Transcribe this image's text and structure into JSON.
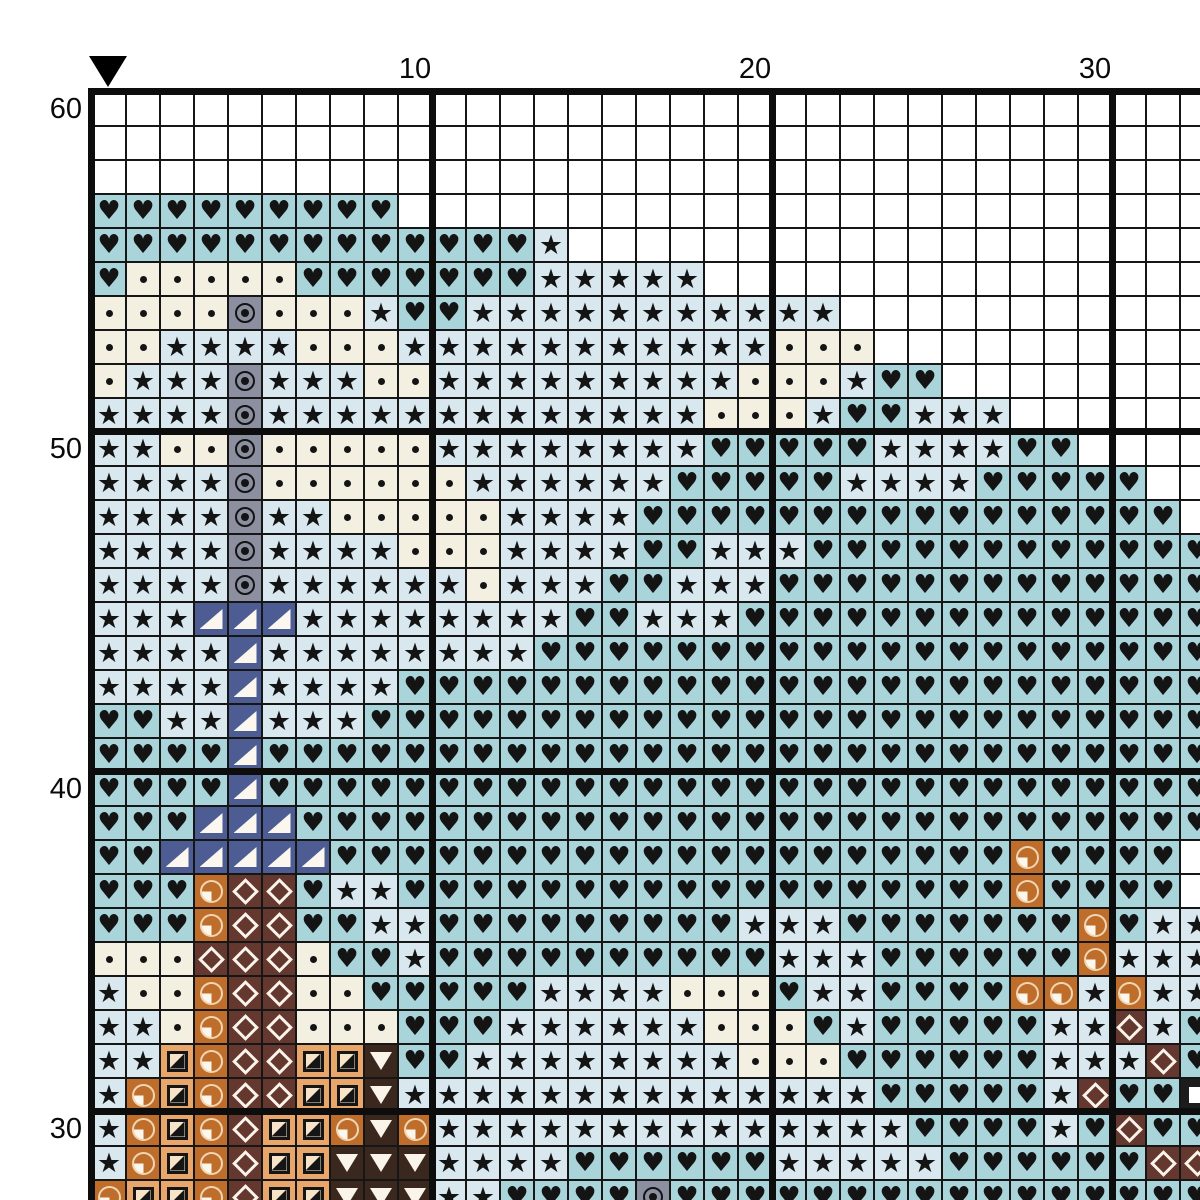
{
  "page": {
    "background": "#ffffff",
    "top_labels": [
      {
        "text": "10",
        "col": 10
      },
      {
        "text": "20",
        "col": 20
      },
      {
        "text": "30",
        "col": 30
      }
    ],
    "left_labels": [
      {
        "text": "60",
        "row": 60
      },
      {
        "text": "50",
        "row": 50
      },
      {
        "text": "40",
        "row": 40
      },
      {
        "text": "30",
        "row": 30
      }
    ],
    "center_marker": "black down-pointing triangle over column 1"
  },
  "chart_data": {
    "type": "heatmap",
    "title": "Cross-stitch pattern chart (detail view)",
    "xlabel": "",
    "ylabel": "",
    "x_tick_labels": [
      "10",
      "20",
      "30"
    ],
    "y_tick_labels": [
      "60",
      "50",
      "40",
      "30"
    ],
    "visible_columns": 33,
    "visible_rows": 33,
    "top_row_number": 60,
    "bottom_row_number": 28,
    "cell_px": 34,
    "grid_on": true,
    "grid_color": "#161616",
    "major_line_every": 10,
    "palette": {
      "w": {
        "name": "blank",
        "shape": "none",
        "bg": "#ffffff"
      },
      "h": {
        "name": "heart",
        "shape": "glyph",
        "glyph": "♥",
        "size": 26,
        "fg": "#141414",
        "bg": "#a9d5da"
      },
      "s": {
        "name": "star",
        "shape": "glyph",
        "glyph": "★",
        "size": 27,
        "fg": "#141414",
        "bg": "#d9e8ee"
      },
      "d": {
        "name": "dot",
        "shape": "dot",
        "fg": "#141414",
        "bg": "#f3f0e1"
      },
      "g": {
        "name": "circled-dot",
        "shape": "target",
        "fg": "#141414",
        "bg": "#8b8fa0"
      },
      "n": {
        "name": "corner-triangle",
        "shape": "tri-lr",
        "fg": "#fbf7ef",
        "bg": "#4d5c93"
      },
      "o": {
        "name": "quarter-circle",
        "shape": "quarter",
        "fg": "#fdf6ec",
        "bg": "#bf6d2a"
      },
      "t": {
        "name": "half-square",
        "shape": "halfsq",
        "fg": "#151515",
        "bg": "#e8a66b"
      },
      "b": {
        "name": "diamond",
        "shape": "diamond",
        "fg": "#faf4ea",
        "bg": "#64372f"
      },
      "v": {
        "name": "down-triangle",
        "shape": "tri-down",
        "fg": "#faf4ea",
        "bg": "#3a281e"
      },
      "q": {
        "name": "white-square",
        "shape": "square",
        "fg": "#ffffff",
        "bg": "#1c1c1c"
      }
    },
    "grid_rows": [
      "wwwwwwwwwwwwwwwwwwwwwwwwwwwwwwwww",
      "wwwwwwwwwwwwwwwwwwwwwwwwwwwwwwwww",
      "wwwwwwwwwwwwwwwwwwwwwwwwwwwwwwwww",
      "hhhhhhhhhwwwwwwwwwwwwwwwwwwwwwwww",
      "hhhhhhhhhhhhhswwwwwwwwwwwwwwwwwww",
      "hdddddhhhhhhhssssswwwwwwwwwwwwwww",
      "ddddgdddshhssssssssssswwwwwwwwwww",
      "ddssssdddsssssssssssdddwwwwwwwwww",
      "dsssgsssddsssssssssdddshhwwwwwwww",
      "ssssgsssssssssssssdddshhssswwwwww",
      "ssddgdddddsssssssshhhhhsssshhwwww",
      "ssssgddddddsssssshhhhhsssshhhhhww",
      "ssssgssdddddsssshhhhhhhhhhhhhhhhw",
      "ssssgssssdddsssshhssshhhhhhhhhhhh",
      "ssssgssssssdssshhssshhhhhhhhhhhhh",
      "sssnnnsssssssshhssshhhhhhhhhhhhhh",
      "ssssnsssssssshhhhhhhhhhhhhhhhhhhh",
      "ssssnsssshhhhhhhhhhhhhhhhhhhhhhhh",
      "hhssnssshhhhhhhhhhhhhhhhhhhhhhhhh",
      "hhhhnhhhhhhhhhhhhhhhhhhhhhhhhhhhh",
      "hhhhnhhhhhhhhhhhhhhhhhhhhhhhhhhhh",
      "hhhnnnhhhhhhhhhhhhhhhhhhhhhhhhhhh",
      "hhnnnnnhhhhhhhhhhhhhhhhhhhhohhhh",
      "hhhobbhsshhhhhhhhhhhhhhhhhhohhhh",
      "hhhobbhhsshhhhhhhhhssshhhhhhhohss",
      "dddbbbdhhshhhhhhhhhhssshhhhhhosss",
      "sddobbddhhhhhssssdddhsshhhhoosos s",
      "ssdobbdddhhhssssssdddhshhhhhssbsh",
      "sstobbttvhhssssssssdddhhhhhhsssbh",
      "sotobbttvsssssssssssssshhhhhsbhhq",
      "sotobttovosssssssssssssshhhhshbhh",
      "sotobttvvvsssshhhhhhssssshhhhhhbb",
      "ottobttvvvsshhhhghhhhhhhhhhhhhhhh"
    ]
  }
}
